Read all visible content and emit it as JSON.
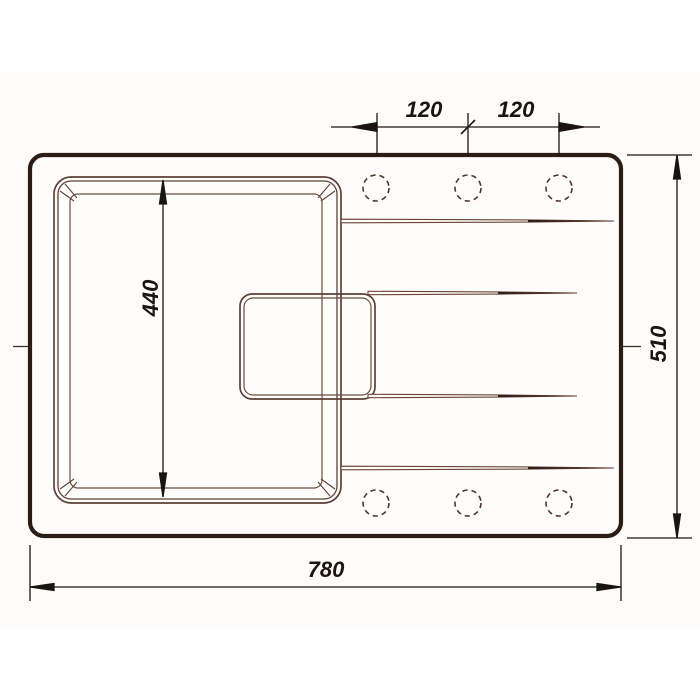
{
  "drawing": {
    "title": "kitchen-sink-top-view-technical-drawing",
    "dimensions": {
      "hole_spacing_left": "120",
      "hole_spacing_right": "120",
      "bowl_inner_height": "440",
      "overall_height": "510",
      "overall_width": "780"
    },
    "features": {
      "tap_holes_top": 3,
      "tap_holes_bottom": 3,
      "drain_grooves": 4
    },
    "colors": {
      "background": "#ffffff",
      "drawing_area_background": "#fdfcf8",
      "sink_outline": "#2b1d16",
      "bowl_line": "#5d4037",
      "bowl_line_light": "#6d4c41",
      "groove_line": "#6d4236",
      "groove_tip": "#241a15",
      "hole_line": "#4e342e",
      "centerline": "#3a2b24",
      "dimension": "#1b1410"
    }
  }
}
